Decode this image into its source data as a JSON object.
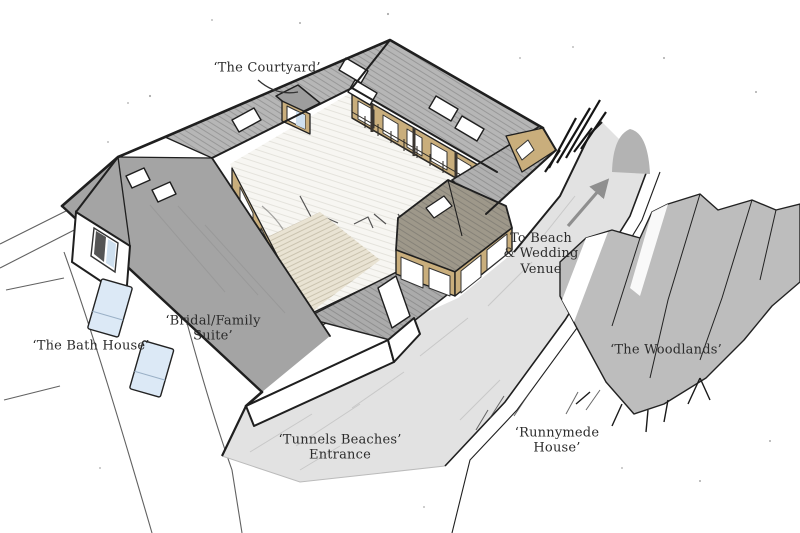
{
  "labels": {
    "courtyard": "‘The Courtyard’",
    "bath_house": "‘The Bath House’",
    "bridal_suite": [
      "‘Bridal/Family",
      "Suite’"
    ],
    "to_beach": [
      "To Beach",
      "& Wedding",
      "Venue"
    ],
    "tunnels_entrance": [
      "‘Tunnels Beaches’",
      "Entrance"
    ],
    "runnymede_house": [
      "‘Runnymede",
      "House’"
    ],
    "woodlands": "‘The Woodlands’"
  },
  "icons": {
    "direction_arrow": "up-right-arrow-to-beach"
  },
  "colors": {
    "ink": "#1f1f1f",
    "label_ink": "#2b2b2b",
    "roof_flat": "#a4a4a4",
    "roof_hatch_base": "#b6b6b6",
    "annex_roof": "#9e988a",
    "wood": "#c9ae7c",
    "window_blue": "#cfe0ef",
    "lounger_blue": "#dce9f6",
    "road_gray": "#e2e2e2",
    "woodland_gray": "#bdbdbd",
    "tunnel_gray": "#b3b3b3",
    "arrow_gray": "#8f8f8f",
    "courtyard_floor": "#f7f6f2",
    "deck_tan": "#e9e3d3"
  }
}
